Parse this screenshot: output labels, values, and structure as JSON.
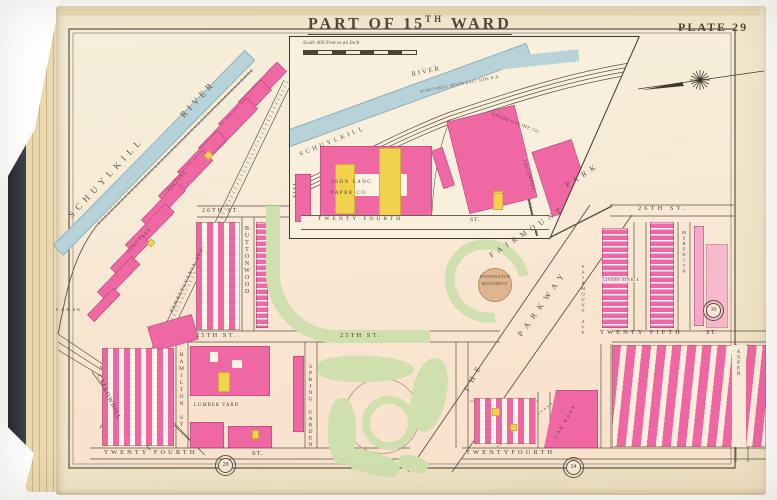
{
  "colors": {
    "building_brick": "#ef67a3",
    "building_frame": "#f2d14d",
    "park_green": "#cfe0ae",
    "river_blue": "#b7d2d8",
    "page_cream": "#f2e7cd",
    "ink": "#4b4238"
  },
  "plate": {
    "title_prefix": "PART OF 15",
    "title_sup": "TH",
    "title_suffix": "WARD",
    "plate_no": "PLATE 29"
  },
  "inset": {
    "scale_caption": "Scale 400 Feet to an Inch",
    "river_word1": "SCHUYLKILL",
    "river_word2": "RIVER",
    "railroad_label": "SCHUYLKILL RIVER EAST SIDE R.R.",
    "gas_label": "UNITED GAS IMP. CO.",
    "paper_label_1": "JOHN LANG",
    "paper_label_2": "PAPER CO.",
    "callowhill_label": "CALLOWHILL",
    "street_24": "TWENTY FOURTH",
    "street_24_suffix": "ST."
  },
  "map": {
    "river_word1": "SCHUYLKILL",
    "river_word2": "RIVER",
    "park_word1": "FAIRMOUNT",
    "park_word2": "PARK",
    "parkway_word1": "THE",
    "parkway_word2": "PARKWAY",
    "monument_line1": "WASHINGTON",
    "monument_line2": "MONUMENT",
    "streets": {
      "s26_west": "26TH ST.",
      "s26_east": "26TH ST.",
      "s25_west": "25TH ST.",
      "s25_mid": "25TH ST.",
      "s25_east": "TWENTY FIFTH",
      "s25_east_suffix": "ST.",
      "s24_west": "TWENTY FOURTH",
      "s24_west_suffix": "ST.",
      "s24_east": "TWENTYFOURTH",
      "hamilton": "HAMILTON ST",
      "buttonwood": "BUTTONWOOD",
      "spring_garden": "SPRING GARDEN",
      "callowhill": "CALLOWHILL",
      "pennsylvania": "PENNSYLVANIA AVE.",
      "fairmount_ave": "FAIRMOUNT AVE.",
      "meredith": "MEREDITH",
      "aspen": "ASPEN"
    },
    "labels": {
      "lumber_yard": "LUMBER YARD",
      "car_barn": "CAR BARN",
      "coal_yard": "COAL YARD",
      "factory": "FACTORY",
      "livery_stable": "LIVERY STABLE",
      "railroad": "P. & R. R.R."
    },
    "plate_refs": {
      "east": "30",
      "south_west": "28",
      "south_east": "24"
    }
  }
}
